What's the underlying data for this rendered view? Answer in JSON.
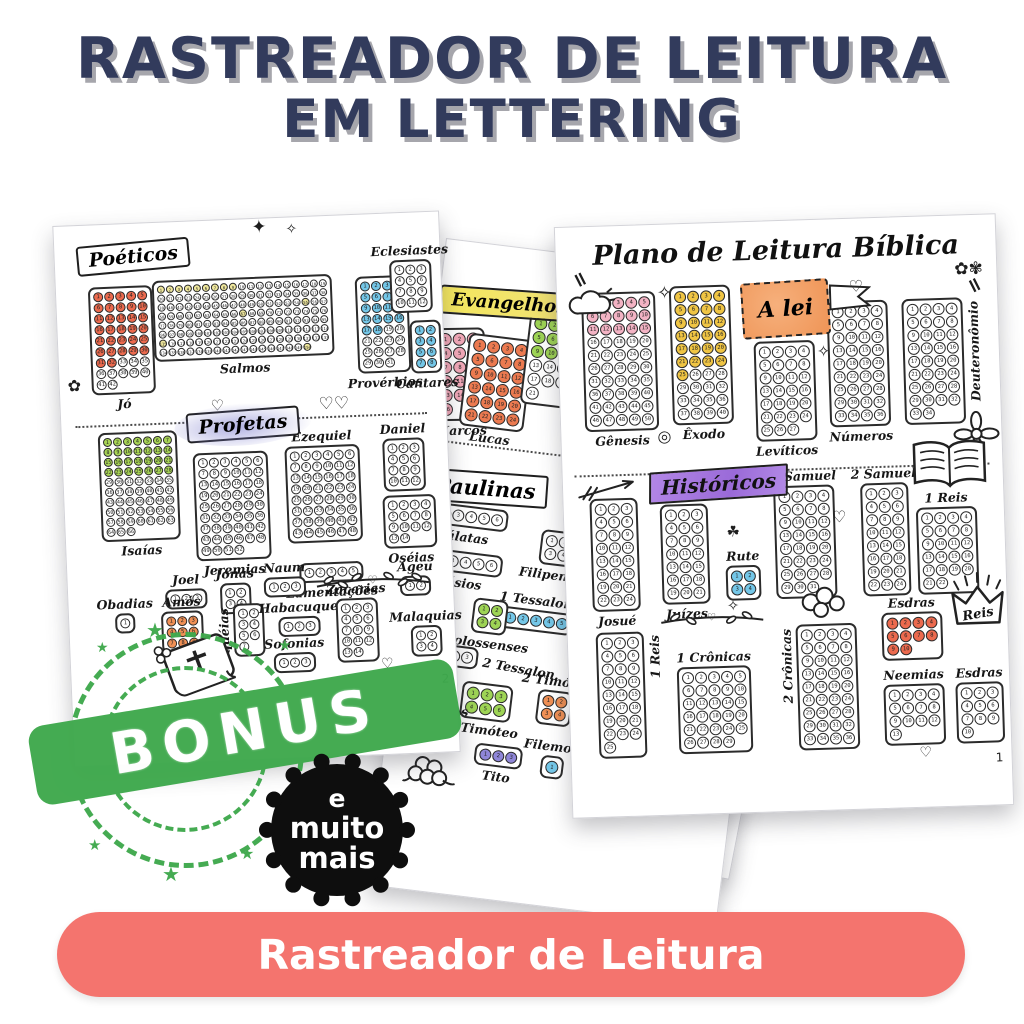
{
  "header": {
    "title_line1": "RASTREADOR DE LEITURA",
    "title_line2": "EM LETTERING"
  },
  "colors": {
    "title_navy": "#323b5c",
    "button_coral": "#f4746e",
    "stamp_green": "#3fa94d",
    "badge_black": "#0e0e0e",
    "fill_pink": "#f3b3c4",
    "fill_gold": "#f0c544",
    "fill_blue": "#74c7e8",
    "fill_green": "#9ed455",
    "fill_red": "#ec6a4e",
    "fill_orange": "#f09055",
    "fill_purple": "#8f86d8",
    "fill_yellow": "#efe79c"
  },
  "pages": {
    "plano": {
      "title": "Plano de Leitura Bíblica",
      "page_number": "1",
      "crown_label": "Reis",
      "sections": [
        {
          "banner": "A lei",
          "books": [
            {
              "name": "Gênesis",
              "chapters": 50,
              "cols": 5,
              "filled": 15,
              "fill_color": "#f3b3c4"
            },
            {
              "name": "Êxodo",
              "chapters": 40,
              "cols": 4,
              "filled": 25,
              "fill_color": "#f0c544"
            },
            {
              "name": "Levíticos",
              "chapters": 27,
              "cols": 4,
              "filled": 0
            },
            {
              "name": "Números",
              "chapters": 36,
              "cols": 4,
              "filled": 0
            },
            {
              "name": "Deuteronômio",
              "chapters": 34,
              "cols": 4,
              "filled": 0
            }
          ]
        },
        {
          "banner": "Históricos",
          "books": [
            {
              "name": "Josué",
              "chapters": 24,
              "cols": 3,
              "filled": 0
            },
            {
              "name": "Juízes",
              "chapters": 21,
              "cols": 3,
              "filled": 0
            },
            {
              "name": "Rute",
              "chapters": 4,
              "cols": 2,
              "filled": 4,
              "fill_color": "#74c7e8"
            },
            {
              "name": "1 Samuel",
              "chapters": 31,
              "cols": 4,
              "filled": 0
            },
            {
              "name": "2 Samuel",
              "chapters": 24,
              "cols": 3,
              "filled": 0
            },
            {
              "name": "1 Reis",
              "chapters": 22,
              "cols": 4,
              "filled": 0
            },
            {
              "name": "1 Reis",
              "chapters": 25,
              "cols": 3,
              "filled": 0
            },
            {
              "name": "1 Crônicas",
              "chapters": 29,
              "cols": 5,
              "filled": 0
            },
            {
              "name": "2 Crônicas",
              "chapters": 36,
              "cols": 4,
              "filled": 0
            },
            {
              "name": "Esdras",
              "chapters": 10,
              "cols": 4,
              "filled": 10,
              "fill_color": "#ec6a4e"
            },
            {
              "name": "Neemias",
              "chapters": 13,
              "cols": 4,
              "filled": 0
            },
            {
              "name": "Esdras",
              "chapters": 10,
              "cols": 3,
              "filled": 0
            }
          ]
        }
      ]
    },
    "poeticos_profetas": {
      "page_number": "2",
      "sections": [
        {
          "banner": "Poéticos",
          "books": [
            {
              "name": "Jó",
              "chapters": 42,
              "cols": 5,
              "filled": 32,
              "fill_color": "#ec6a4e"
            },
            {
              "name": "Salmos",
              "chapters": 150,
              "cols": 19,
              "filled": 9,
              "also_filled": [
                55,
                67,
                115,
                150
              ],
              "fill_color": "#efe79c"
            },
            {
              "name": "Provérbios",
              "chapters": 31,
              "cols": 4,
              "filled": 18,
              "fill_color": "#74c7e8"
            },
            {
              "name": "Eclesiastes",
              "chapters": 12,
              "cols": 3,
              "filled": 0
            },
            {
              "name": "Cantares",
              "chapters": 8,
              "cols": 2,
              "filled": 8,
              "fill_color": "#74c7e8"
            }
          ]
        },
        {
          "banner": "Profetas",
          "books": [
            {
              "name": "Isaías",
              "chapters": 66,
              "cols": 7,
              "filled": 28,
              "fill_color": "#a8d455"
            },
            {
              "name": "Jeremias",
              "chapters": 52,
              "cols": 6,
              "filled": 0
            },
            {
              "name": "Ezequiel",
              "chapters": 48,
              "cols": 6,
              "filled": 0
            },
            {
              "name": "Daniel",
              "chapters": 12,
              "cols": 3,
              "filled": 0
            },
            {
              "name": "Lamentações",
              "chapters": 5,
              "cols": 5,
              "filled": 0
            },
            {
              "name": "Oséias",
              "chapters": 14,
              "cols": 4,
              "filled": 0
            },
            {
              "name": "Joel",
              "chapters": 3,
              "cols": 3,
              "filled": 0
            },
            {
              "name": "Jonas",
              "chapters": 4,
              "cols": 2,
              "filled": 0
            },
            {
              "name": "Naum",
              "chapters": 3,
              "cols": 3,
              "filled": 0
            },
            {
              "name": "Obadias",
              "chapters": 1,
              "cols": 1,
              "filled": 0
            },
            {
              "name": "Amós",
              "chapters": 9,
              "cols": 3,
              "filled": 9,
              "fill_color": "#f09055"
            },
            {
              "name": "Miquéias",
              "chapters": 7,
              "cols": 2,
              "filled": 0
            },
            {
              "name": "Habacuque",
              "chapters": 3,
              "cols": 3,
              "filled": 0
            },
            {
              "name": "Sofonias",
              "chapters": 3,
              "cols": 3,
              "filled": 0
            },
            {
              "name": "Zacarias",
              "chapters": 14,
              "cols": 3,
              "filled": 0
            },
            {
              "name": "Ageu",
              "chapters": 2,
              "cols": 2,
              "filled": 0
            },
            {
              "name": "Malaquias",
              "chapters": 4,
              "cols": 2,
              "filled": 0
            }
          ]
        }
      ]
    },
    "evangelhos_paulinas": {
      "corintios2_label": "2 Corintios",
      "sections": [
        {
          "banner": "Evangelhos",
          "books": [
            {
              "name": "Marcos",
              "chapters": 16,
              "cols": 3,
              "filled": 16,
              "fill_color": "#f2a8b8"
            },
            {
              "name": "Lucas",
              "chapters": 24,
              "cols": 4,
              "filled": 24,
              "fill_color": "#ec7a50"
            },
            {
              "name": "João",
              "chapters": 21,
              "cols": 4,
              "filled": 12,
              "fill_color": "#9ed455"
            }
          ]
        },
        {
          "banner": "Paulinas",
          "books": [
            {
              "name": "Gálatas",
              "chapters": 6,
              "cols": 6,
              "filled": 0
            },
            {
              "name": "Efésios",
              "chapters": 6,
              "cols": 6,
              "filled": 0
            },
            {
              "name": "Filipenses",
              "chapters": 4,
              "cols": 2,
              "filled": 0
            },
            {
              "name": "Colossenses",
              "chapters": 4,
              "cols": 2,
              "filled": 4,
              "fill_color": "#9ed455"
            },
            {
              "name": "1 Tessalon.",
              "chapters": 5,
              "cols": 5,
              "filled": 5,
              "fill_color": "#74c7e8"
            },
            {
              "name": "2 Tessalon.",
              "chapters": 3,
              "cols": 3,
              "filled": 0
            },
            {
              "name": "1 Timóteo",
              "chapters": 6,
              "cols": 3,
              "filled": 6,
              "fill_color": "#9ed455"
            },
            {
              "name": "2 Timóteo",
              "chapters": 4,
              "cols": 2,
              "filled": 4,
              "fill_color": "#f09055"
            },
            {
              "name": "Tito",
              "chapters": 3,
              "cols": 3,
              "filled": 3,
              "fill_color": "#8f86d8"
            },
            {
              "name": "Filemom",
              "chapters": 1,
              "cols": 1,
              "filled": 1,
              "fill_color": "#74c7e8"
            }
          ]
        }
      ]
    }
  },
  "stamp": {
    "label": "BONUS"
  },
  "badge": {
    "line1": "e",
    "line2": "muito",
    "line3": "mais"
  },
  "cta": {
    "label": "Rastreador de Leitura"
  }
}
